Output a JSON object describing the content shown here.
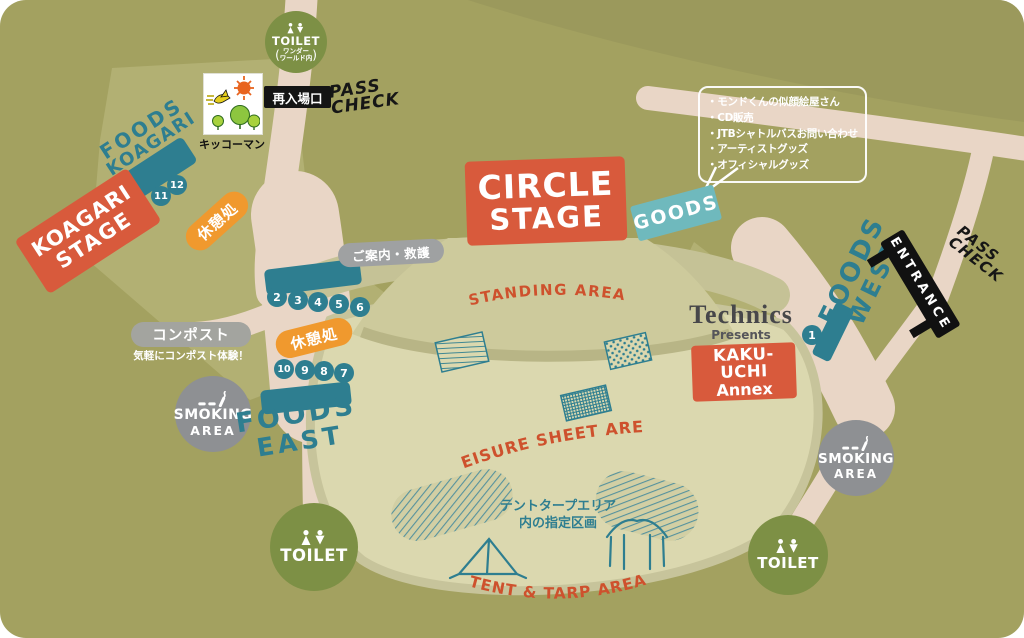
{
  "colors": {
    "base": "#a3a160",
    "base_dark": "#9b995c",
    "light_patch": "#b2b073",
    "path_pink": "#e9d6c6",
    "leisure": "#dbd8af",
    "standing": "#cdca9c",
    "walkway": "#c5c296",
    "teal": "#2e7e90",
    "teal_light": "#6fb9bd",
    "red": "#d85a3c",
    "red_text": "#ce512d",
    "orange": "#f0992e",
    "gray": "#8e9093",
    "toilet_green": "#7d9045",
    "black": "#1a1a1a"
  },
  "icons": {
    "toilet": "male-female-restroom-figures",
    "smoking": "cigarette-with-smoke",
    "kikkoman_logo": "sun-bird-trees"
  },
  "stages": {
    "circle": {
      "line1": "CIRCLE",
      "line2": "STAGE"
    },
    "koagari": {
      "line1": "KOAGARI",
      "line2": "STAGE"
    }
  },
  "areas": {
    "standing": "STANDING AREA",
    "leisure": "LEISURE SHEET AREA",
    "tent_tarp": "TENT & TARP AREA",
    "tent_note_line1": "テントタープエリア",
    "tent_note_line2": "内の指定区画"
  },
  "foods": {
    "koagari": {
      "line1": "FOODS",
      "line2": "KOAGARI"
    },
    "east": {
      "line1": "FOODS",
      "line2": "EAST"
    },
    "west": {
      "line1": "FOODS",
      "line2": "WEST"
    }
  },
  "labels": {
    "toilet": "TOILET",
    "toilet_note_open": "(",
    "toilet_note_line1": "ワンダー",
    "toilet_note_line2": "ワールド内",
    "toilet_note_close": ")",
    "smoking_line1": "SMOKING",
    "smoking_line2": "AREA",
    "goods": "GOODS",
    "entrance": "ENTRANCE",
    "pass_line1": "PASS",
    "pass_line2": "CHECK",
    "reentry": "再入場口",
    "kikkoman": "キッコーマン",
    "info_aid": "ご案内・救護",
    "compost_title": "コンポスト",
    "compost_sub": "気軽にコンポスト体験！",
    "rest": "休憩処",
    "technics": "Technics",
    "presents": "Presents",
    "kakuuchi_line1": "KAKU-UCHI",
    "kakuuchi_line2": "Annex"
  },
  "bubble": {
    "items": [
      "・モンドくんの似顔絵屋さん",
      "・CD販売",
      "・JTBシャトルバスお問い合わせ",
      "・アーティストグッズ",
      "・オフィシャルグッズ"
    ]
  },
  "stalls": {
    "koagari": [
      "11",
      "12"
    ],
    "east_row1": [
      "2",
      "3",
      "4",
      "5",
      "6"
    ],
    "east_row2": [
      "10",
      "9",
      "8",
      "7"
    ],
    "west": [
      "1"
    ]
  }
}
